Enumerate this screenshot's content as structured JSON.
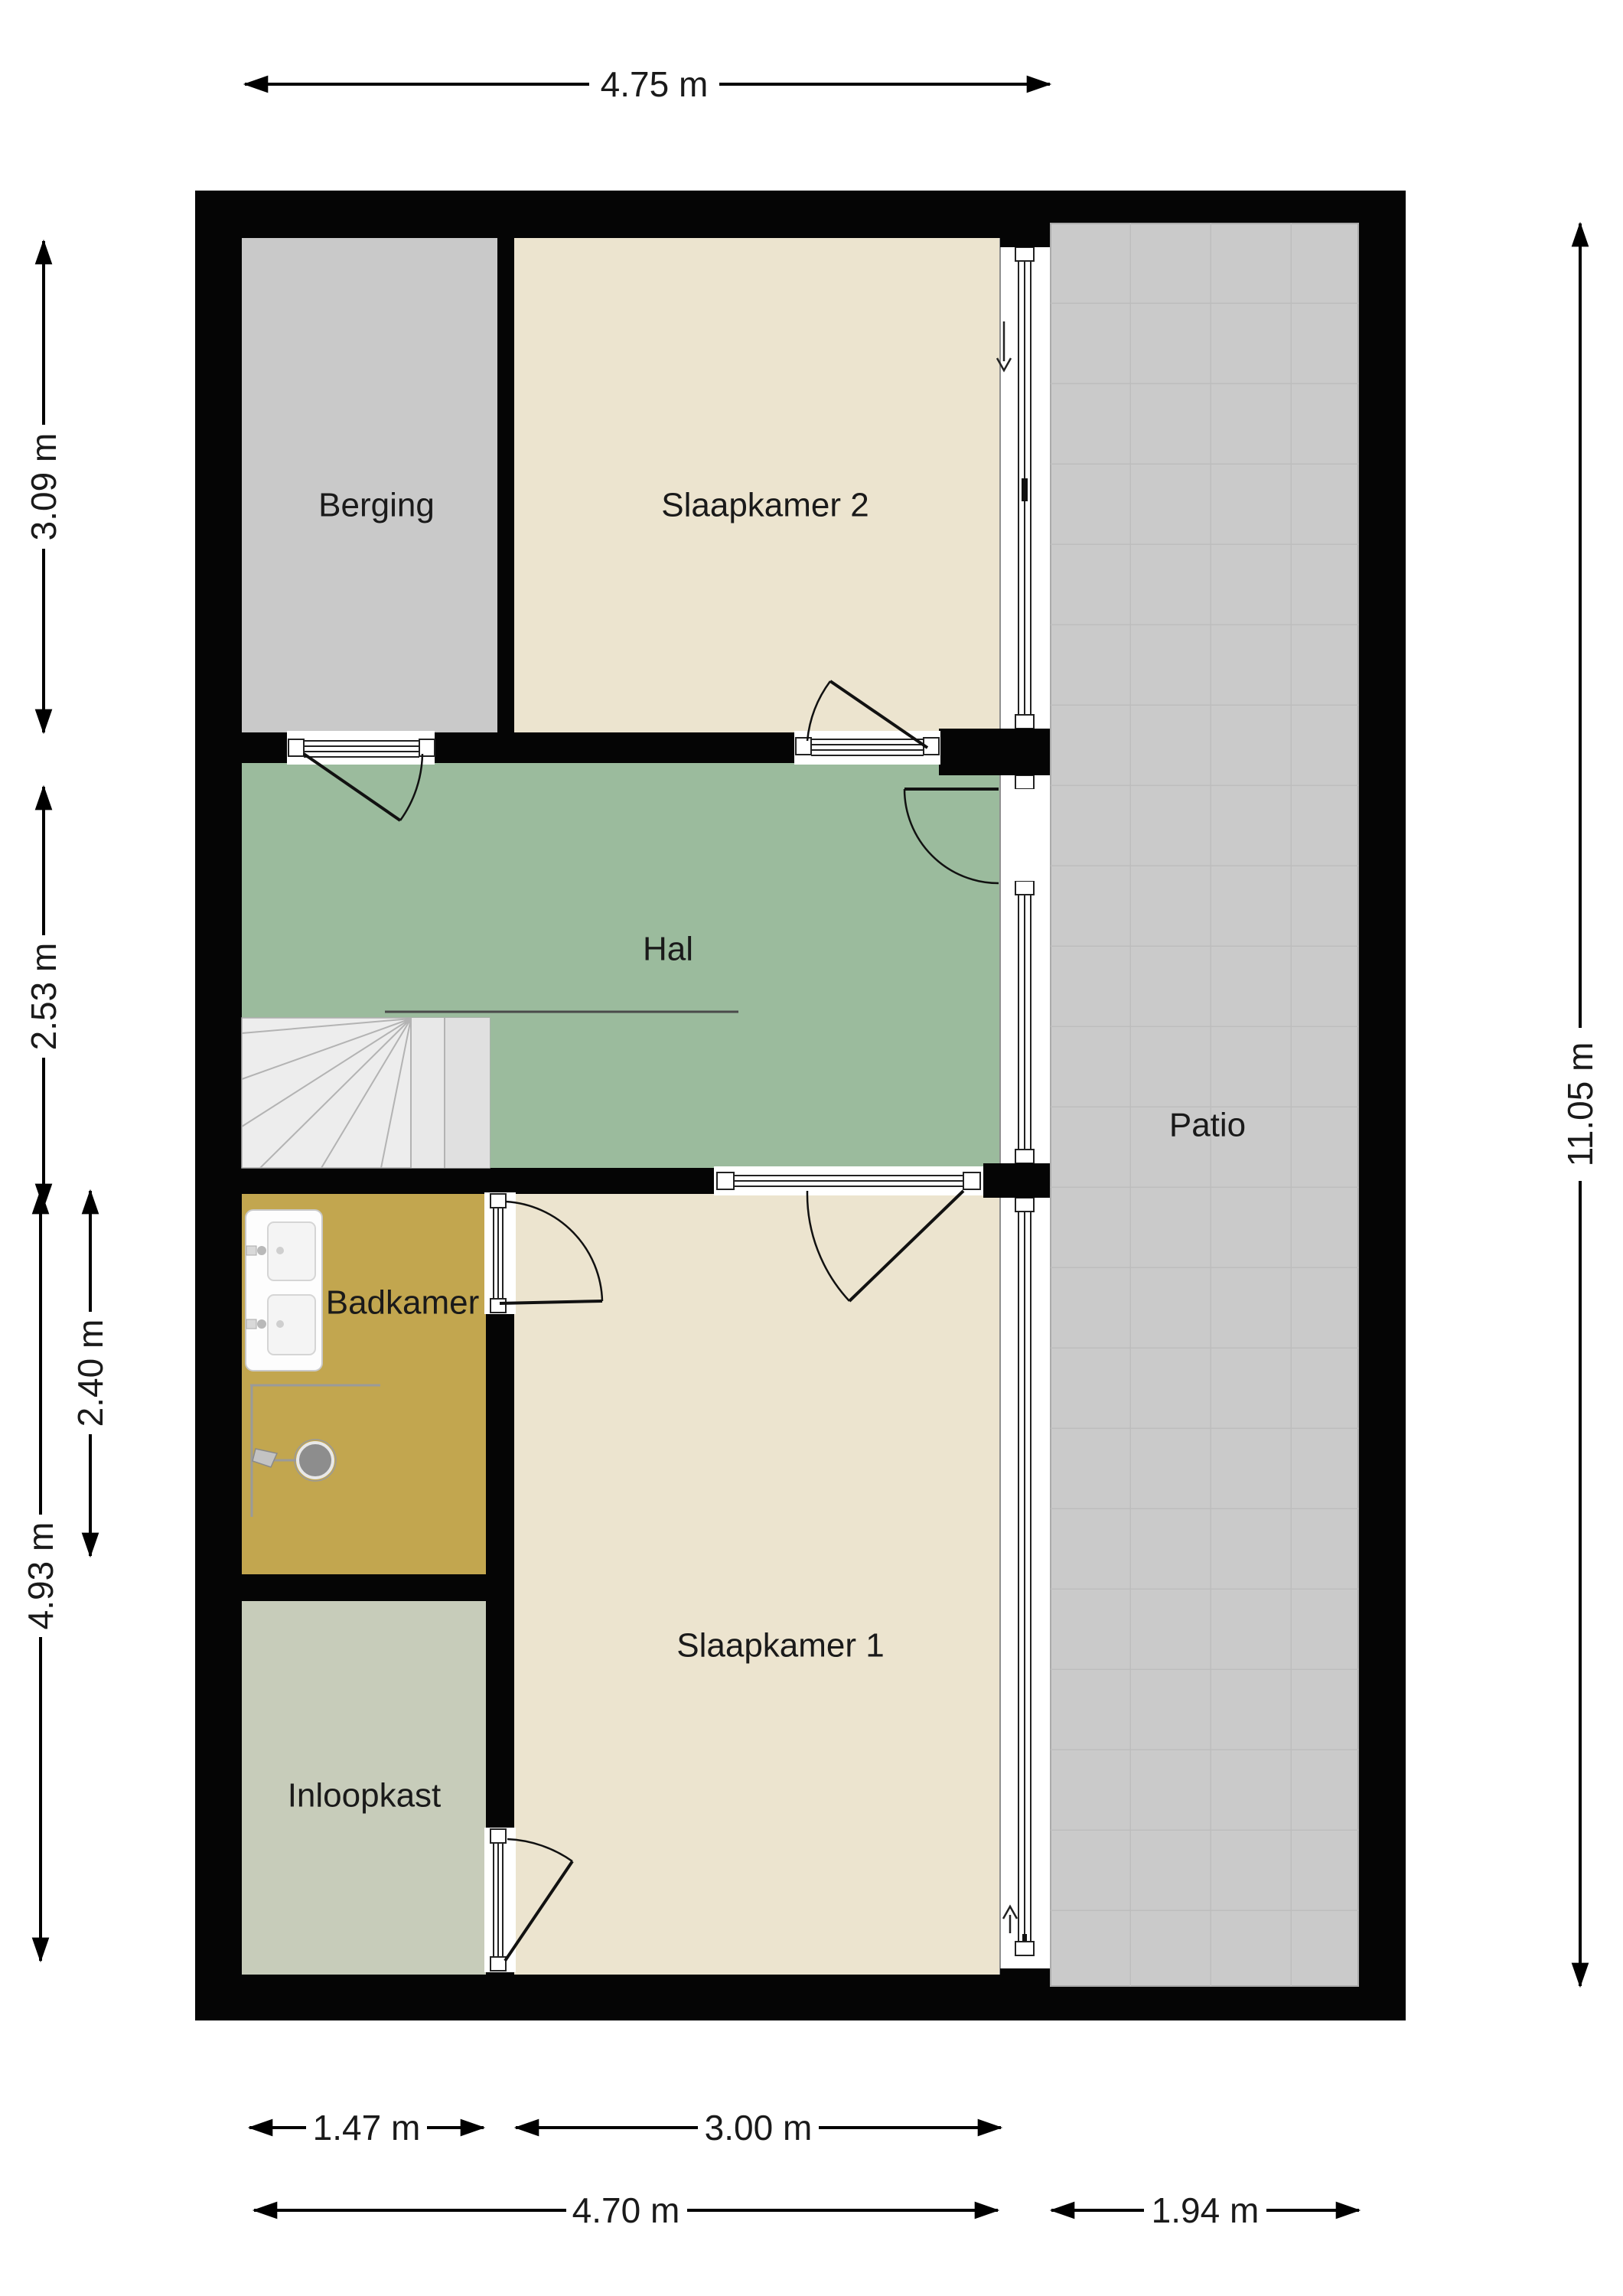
{
  "floorplan": {
    "rooms": {
      "berging": {
        "label": "Berging"
      },
      "slaapkamer2": {
        "label": "Slaapkamer 2"
      },
      "hal": {
        "label": "Hal"
      },
      "badkamer": {
        "label": "Badkamer"
      },
      "slaapkamer1": {
        "label": "Slaapkamer 1"
      },
      "inloopkast": {
        "label": "Inloopkast"
      },
      "patio": {
        "label": "Patio"
      }
    },
    "dimensions": {
      "top_width": "4.75 m",
      "berging_height": "3.09 m",
      "hal_height": "2.53 m",
      "badkamer_height": "2.40 m",
      "lower_left_height": "4.93 m",
      "total_height": "11.05 m",
      "inloopkast_width": "1.47 m",
      "slaapkamer1_width": "3.00 m",
      "interior_width": "4.70 m",
      "patio_width": "1.94 m"
    },
    "colors": {
      "wall": "#050505",
      "berging": "#c9c9c9",
      "bedroom": "#ece4cf",
      "hal": "#9bbb9d",
      "badkamer": "#c2a64f",
      "inloopkast": "#c7ccba",
      "patio": "#cacaca",
      "stairs": "#ededed",
      "dimension_text": "#1a1a1a"
    },
    "indicators": {
      "slaapkamer2_arrow": "down",
      "slaapkamer1_arrow": "up"
    }
  }
}
